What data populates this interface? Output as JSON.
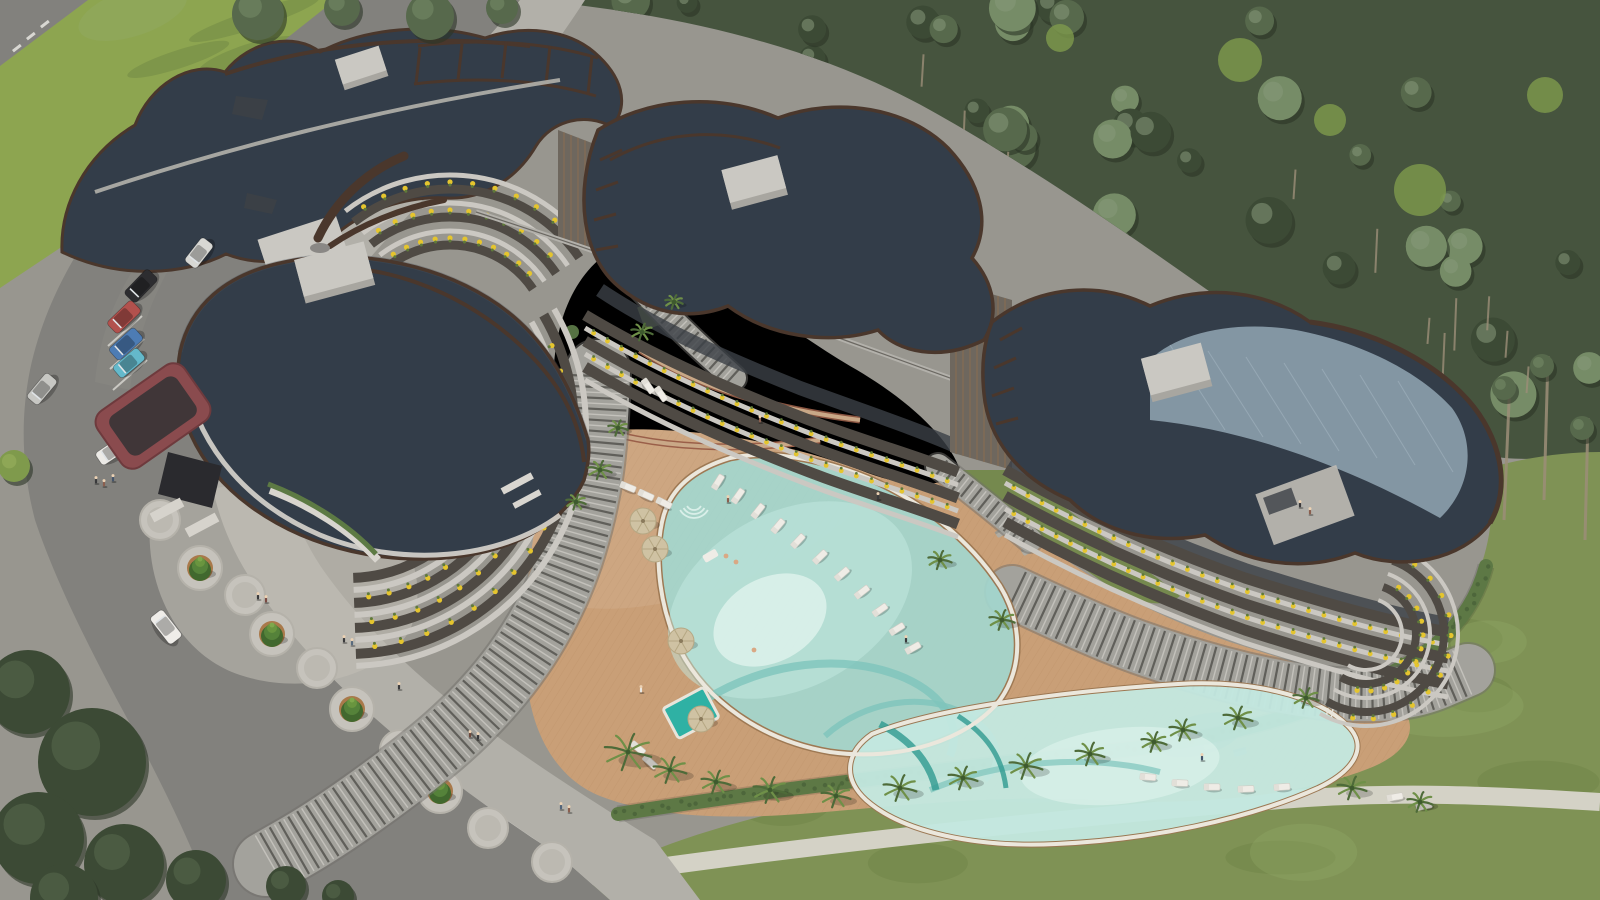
{
  "meta": {
    "title": "Aerial 3D architectural rendering of a curved residential complex with lagoon pool and pine forest",
    "view": "aerial oblique",
    "image_type": "3d-render"
  },
  "palette": {
    "pavement": "#98968f",
    "road": "#82817d",
    "road_line": "#e8e6e0",
    "sidewalk": "#b2b0a9",
    "plaza": "#c2bfb7",
    "grass_top": "#8da550",
    "grass_bottom": "#7f9255",
    "grass_mlight": "#93a967",
    "grass_mdark": "#697f41",
    "forest_base": "#46543e",
    "forest_dark": "#3c4a35",
    "forest_mid": "#57694c",
    "forest_light": "#768c67",
    "trunk": "#9c8e78",
    "forest_grass": "#7e9a4c",
    "hedge": "#5d7845",
    "hedge_dark": "#4a6138",
    "deck": "#c99f77",
    "deck_line": "#b2855c",
    "pool_water": "#a3d8d0",
    "pool_light": "#c4e9e1",
    "pool_core": "#e0f3ec",
    "pool_swirl": "#7ec4bc",
    "pool_coping": "#ebe7dc",
    "jacuzzi": "#2fb1a4",
    "roof": "#333d49",
    "roof_light": "#49545f",
    "roof_sheen": "#9fb4c2",
    "trim": "#4a372c",
    "slab": "#cbc8c2",
    "facade_dark": "#4f4a44",
    "glass": "#3b4046",
    "wood": "#8a6f52",
    "tower": "#6e675e",
    "planter": "#e5c52e",
    "plant_green": "#5f7a3a",
    "roofbox": "#cac8c2",
    "roofbox_side": "#a8a6a0",
    "canopy": "#8a4b4e",
    "canopy_inner": "#323235",
    "lounger": "#efece6",
    "umbrella": "#cfc2a3",
    "sofa": "#b0aca2",
    "palm_dark": "#4e6b39",
    "palm_light": "#6f9048",
    "cone_dark": "#41682e",
    "cone_light": "#69953f",
    "ring_brick": "#a9794a",
    "medallion": "#c6c3bc",
    "path_white": "#d9d6cc",
    "brick_edge": "#9a5f49",
    "brick_fill": "#c9a887",
    "skin": "#d9a884"
  },
  "scene": {
    "cars": [
      {
        "name": "white-van",
        "x": 199,
        "y": 253,
        "a": -52,
        "c": "#d8d8d4",
        "l": 30,
        "w": 15
      },
      {
        "name": "black-car",
        "x": 141,
        "y": 286,
        "a": -46,
        "c": "#2d2d30",
        "l": 34,
        "w": 16
      },
      {
        "name": "red-car",
        "x": 124,
        "y": 317,
        "a": -44,
        "c": "#b2514d",
        "l": 34,
        "w": 16
      },
      {
        "name": "blue-car",
        "x": 126,
        "y": 344,
        "a": -42,
        "c": "#4d7cb4",
        "l": 34,
        "w": 16
      },
      {
        "name": "teal-car",
        "x": 129,
        "y": 363,
        "a": -40,
        "c": "#64b9cb",
        "l": 32,
        "w": 15
      },
      {
        "name": "silver-car",
        "x": 42,
        "y": 389,
        "a": -50,
        "c": "#c7c7c3",
        "l": 32,
        "w": 15
      },
      {
        "name": "white-car-entrance",
        "x": 112,
        "y": 451,
        "a": -34,
        "c": "#eceae6",
        "l": 32,
        "w": 15
      },
      {
        "name": "white-car-road",
        "x": 166,
        "y": 627,
        "a": 52,
        "c": "#efede9",
        "l": 34,
        "w": 16
      }
    ],
    "umbrellas": [
      [
        643,
        521
      ],
      [
        655,
        549
      ],
      [
        681,
        641
      ],
      [
        701,
        719
      ]
    ],
    "loungers": [
      [
        718,
        482,
        -58
      ],
      [
        738,
        496,
        -55
      ],
      [
        758,
        511,
        -52
      ],
      [
        778,
        526,
        -50
      ],
      [
        798,
        541,
        -47
      ],
      [
        820,
        557,
        -44
      ],
      [
        842,
        574,
        -41
      ],
      [
        862,
        592,
        -38
      ],
      [
        880,
        610,
        -35
      ],
      [
        897,
        629,
        -32
      ],
      [
        913,
        648,
        -29
      ],
      [
        628,
        487,
        22
      ],
      [
        646,
        495,
        24
      ],
      [
        664,
        503,
        26
      ],
      [
        1148,
        777,
        4
      ],
      [
        1180,
        783,
        2
      ],
      [
        1212,
        787,
        0
      ],
      [
        1246,
        789,
        -2
      ],
      [
        1282,
        787,
        -4
      ],
      [
        1395,
        797,
        -10
      ],
      [
        1424,
        806,
        -12
      ],
      [
        648,
        386,
        55
      ],
      [
        661,
        394,
        55
      ],
      [
        638,
        748,
        40
      ],
      [
        650,
        762,
        42
      ]
    ],
    "sofas": [
      [
        884,
        488,
        -28
      ],
      [
        908,
        506,
        -28
      ],
      [
        1002,
        532,
        -30
      ],
      [
        1028,
        550,
        -30
      ],
      [
        1210,
        745,
        -15
      ],
      [
        1240,
        752,
        -15
      ]
    ],
    "conical_trees": [
      [
        200,
        568
      ],
      [
        272,
        634
      ],
      [
        352,
        709
      ],
      [
        440,
        791
      ]
    ],
    "medallions": [
      [
        160,
        520
      ],
      [
        245,
        595
      ],
      [
        317,
        668
      ],
      [
        400,
        750
      ],
      [
        488,
        828
      ],
      [
        552,
        862
      ]
    ],
    "people": [
      [
        96,
        481,
        "#3a3a3c"
      ],
      [
        104,
        484,
        "#8a5f4f"
      ],
      [
        113,
        479,
        "#45556b"
      ],
      [
        258,
        597,
        "#3a3a3c"
      ],
      [
        266,
        600,
        "#7a4a42"
      ],
      [
        344,
        640,
        "#3a3a3c"
      ],
      [
        352,
        643,
        "#596b7e"
      ],
      [
        399,
        687,
        "#3a3a3c"
      ],
      [
        470,
        735,
        "#6e4a3e"
      ],
      [
        478,
        737,
        "#3a3a3c"
      ],
      [
        561,
        807,
        "#53657a"
      ],
      [
        569,
        810,
        "#8a5f4f"
      ],
      [
        641,
        690,
        "#e9e7e2"
      ],
      [
        728,
        500,
        "#8a5f4f"
      ],
      [
        906,
        640,
        "#3a3a3c"
      ],
      [
        760,
        420,
        "#8a5f4f"
      ],
      [
        878,
        497,
        "#3a3a3c"
      ],
      [
        1202,
        758,
        "#45556b"
      ],
      [
        1300,
        505,
        "#3a3a3c"
      ],
      [
        1310,
        512,
        "#8a5f4f"
      ]
    ],
    "swimmers": [
      [
        726,
        556
      ],
      [
        736,
        562
      ],
      [
        754,
        650
      ]
    ],
    "palms": [
      [
        628,
        752,
        24
      ],
      [
        670,
        770,
        17
      ],
      [
        716,
        782,
        15
      ],
      [
        770,
        790,
        17
      ],
      [
        836,
        796,
        15
      ],
      [
        900,
        788,
        17
      ],
      [
        963,
        778,
        15
      ],
      [
        1026,
        766,
        17
      ],
      [
        1090,
        754,
        15
      ],
      [
        1154,
        742,
        13
      ],
      [
        1238,
        718,
        15
      ],
      [
        1306,
        698,
        13
      ],
      [
        600,
        470,
        12
      ],
      [
        618,
        428,
        10
      ],
      [
        576,
        502,
        10
      ],
      [
        642,
        332,
        11
      ],
      [
        674,
        302,
        9
      ],
      [
        940,
        560,
        12
      ],
      [
        1002,
        620,
        13
      ],
      [
        1183,
        730,
        14
      ],
      [
        1352,
        788,
        15
      ],
      [
        1420,
        802,
        13
      ]
    ],
    "tree_clusters_bl": [
      [
        28,
        692,
        42
      ],
      [
        92,
        762,
        54
      ],
      [
        38,
        838,
        46
      ],
      [
        124,
        864,
        40
      ],
      [
        196,
        880,
        30
      ],
      [
        64,
        898,
        34
      ],
      [
        286,
        886,
        20
      ],
      [
        338,
        896,
        16
      ]
    ],
    "tree_clusters_top": [
      [
        258,
        14,
        26
      ],
      [
        342,
        8,
        18
      ],
      [
        430,
        16,
        24
      ],
      [
        502,
        8,
        16
      ]
    ],
    "bush_left": [
      14,
      466,
      16
    ],
    "forest_regions": [
      [
        540,
        0,
        1050,
        130,
        24
      ],
      [
        780,
        120,
        810,
        130,
        20
      ],
      [
        1020,
        250,
        570,
        120,
        15
      ],
      [
        1270,
        365,
        320,
        100,
        9
      ]
    ],
    "forest_patches": [
      [
        1240,
        60,
        22
      ],
      [
        1420,
        190,
        26
      ],
      [
        1545,
        95,
        18
      ],
      [
        1060,
        38,
        14
      ],
      [
        1330,
        120,
        16
      ]
    ],
    "right_trunks": [
      [
        1510,
        378,
        1504,
        520
      ],
      [
        1548,
        356,
        1544,
        500
      ],
      [
        1588,
        418,
        1585,
        540
      ]
    ]
  }
}
